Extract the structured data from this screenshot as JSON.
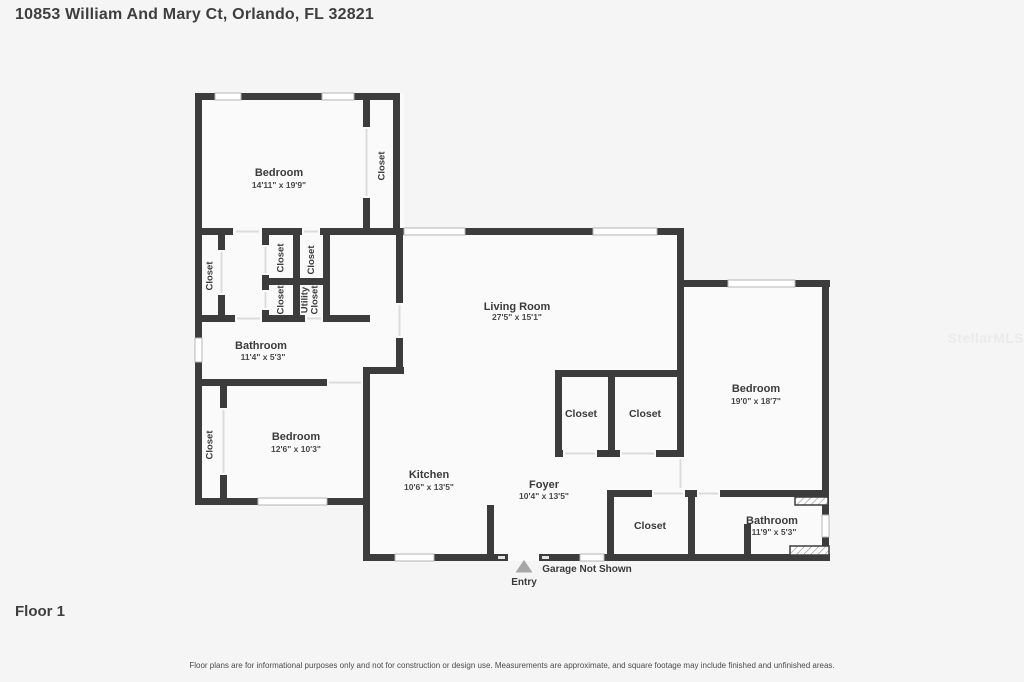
{
  "header": {
    "title": "10853 William And Mary Ct, Orlando, FL 32821"
  },
  "plan": {
    "rooms": {
      "bedroom_1": {
        "label": "Bedroom",
        "dims": "14'11\" x 19'9\""
      },
      "bathroom_1": {
        "label": "Bathroom",
        "dims": "11'4\" x 5'3\""
      },
      "bedroom_2": {
        "label": "Bedroom",
        "dims": "12'6\" x 10'3\""
      },
      "living_room": {
        "label": "Living Room",
        "dims": "27'5\" x 15'1\""
      },
      "kitchen": {
        "label": "Kitchen",
        "dims": "10'6\" x 13'5\""
      },
      "foyer": {
        "label": "Foyer",
        "dims": "10'4\" x 13'5\""
      },
      "bedroom_3": {
        "label": "Bedroom",
        "dims": "19'0\" x 18'7\""
      },
      "bathroom_2": {
        "label": "Bathroom",
        "dims": "11'9\" x 5'3\""
      }
    },
    "closet_label": "Closet",
    "utility_closet": {
      "line1": "Utility",
      "line2": "Closet"
    },
    "entry_label": "Entry",
    "garage_note": "Garage Not Shown"
  },
  "footer": {
    "floor_label": "Floor 1",
    "disclaimer": "Floor plans are for informational purposes only and not for construction or design use. Measurements are approximate, and square footage may include finished and unfinished areas."
  },
  "watermark": "StellarMLS",
  "colors": {
    "wall": "#3c3c3c",
    "room_fill": "#fafafa",
    "background": "#f5f5f5",
    "label_text": "#3a3a3a",
    "window_border": "#b5b5b5",
    "entry_arrow": "#a6a6a6"
  }
}
